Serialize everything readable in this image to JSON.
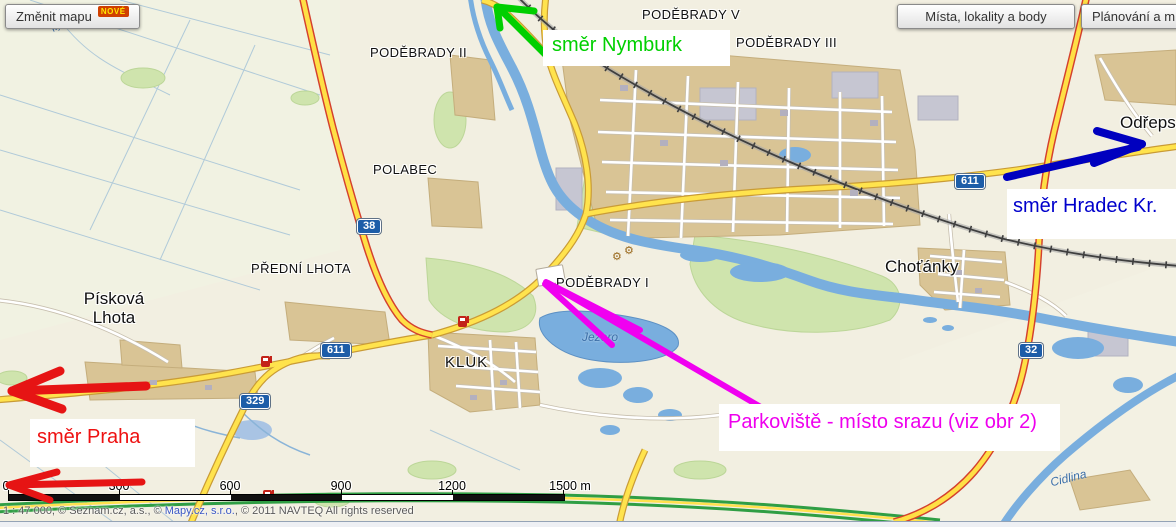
{
  "toolbar": {
    "change_map": {
      "label": "Změnit mapu",
      "badge": "NOVÉ"
    },
    "places_button": "Místa, lokality a body",
    "planning_button": "Plánování a m"
  },
  "map": {
    "place_labels": [
      {
        "id": "podebrady-v",
        "text": "PODĚBRADY V"
      },
      {
        "id": "podebrady-iii",
        "text": "PODĚBRADY III"
      },
      {
        "id": "podebrady-ii",
        "text": "PODĚBRADY II"
      },
      {
        "id": "polabec",
        "text": "POLABEC"
      },
      {
        "id": "predni-lhota",
        "text": "PŘEDNÍ LHOTA"
      },
      {
        "id": "piskova-lhota",
        "text": "Písková Lhota",
        "line1": "Písková",
        "line2": "Lhota"
      },
      {
        "id": "kluk",
        "text": "KLUK"
      },
      {
        "id": "podebrady-i",
        "text": "PODĚBRADY I"
      },
      {
        "id": "chotanky",
        "text": "Choťánky"
      },
      {
        "id": "odreps",
        "text": "Odřeps"
      }
    ],
    "water_labels": [
      {
        "id": "jezero",
        "text": "Jezero"
      },
      {
        "id": "cidlina",
        "text": "Cidlina"
      },
      {
        "id": "stream",
        "text": "ký p."
      }
    ],
    "road_shields": [
      {
        "number": "38"
      },
      {
        "number": "611"
      },
      {
        "number": "329"
      },
      {
        "number": "611"
      },
      {
        "number": "32"
      }
    ],
    "icons": [
      {
        "name": "fuel-station-icon",
        "count": 3
      },
      {
        "name": "gear-icon",
        "count": 2
      }
    ]
  },
  "annotations": [
    {
      "id": "nymburk",
      "text": "směr Nymburk",
      "color": "#00d000"
    },
    {
      "id": "hradec",
      "text": "směr Hradec Kr.",
      "color": "#0000cc"
    },
    {
      "id": "praha",
      "text": "směr Praha",
      "color": "#ee1111"
    },
    {
      "id": "parkoviste",
      "text": "Parkoviště - místo srazu (viz obr 2)",
      "color": "#ee00ee"
    }
  ],
  "scale_bar": {
    "labels": [
      "0",
      "300",
      "600",
      "900",
      "1200",
      "1500 m"
    ]
  },
  "copyright": {
    "prefix": "1 : 47 000, © Seznam.cz, a.s., © ",
    "link": "Mapy.cz, s.r.o.",
    "suffix": ", © 2011 NAVTEQ All rights reserved"
  }
}
